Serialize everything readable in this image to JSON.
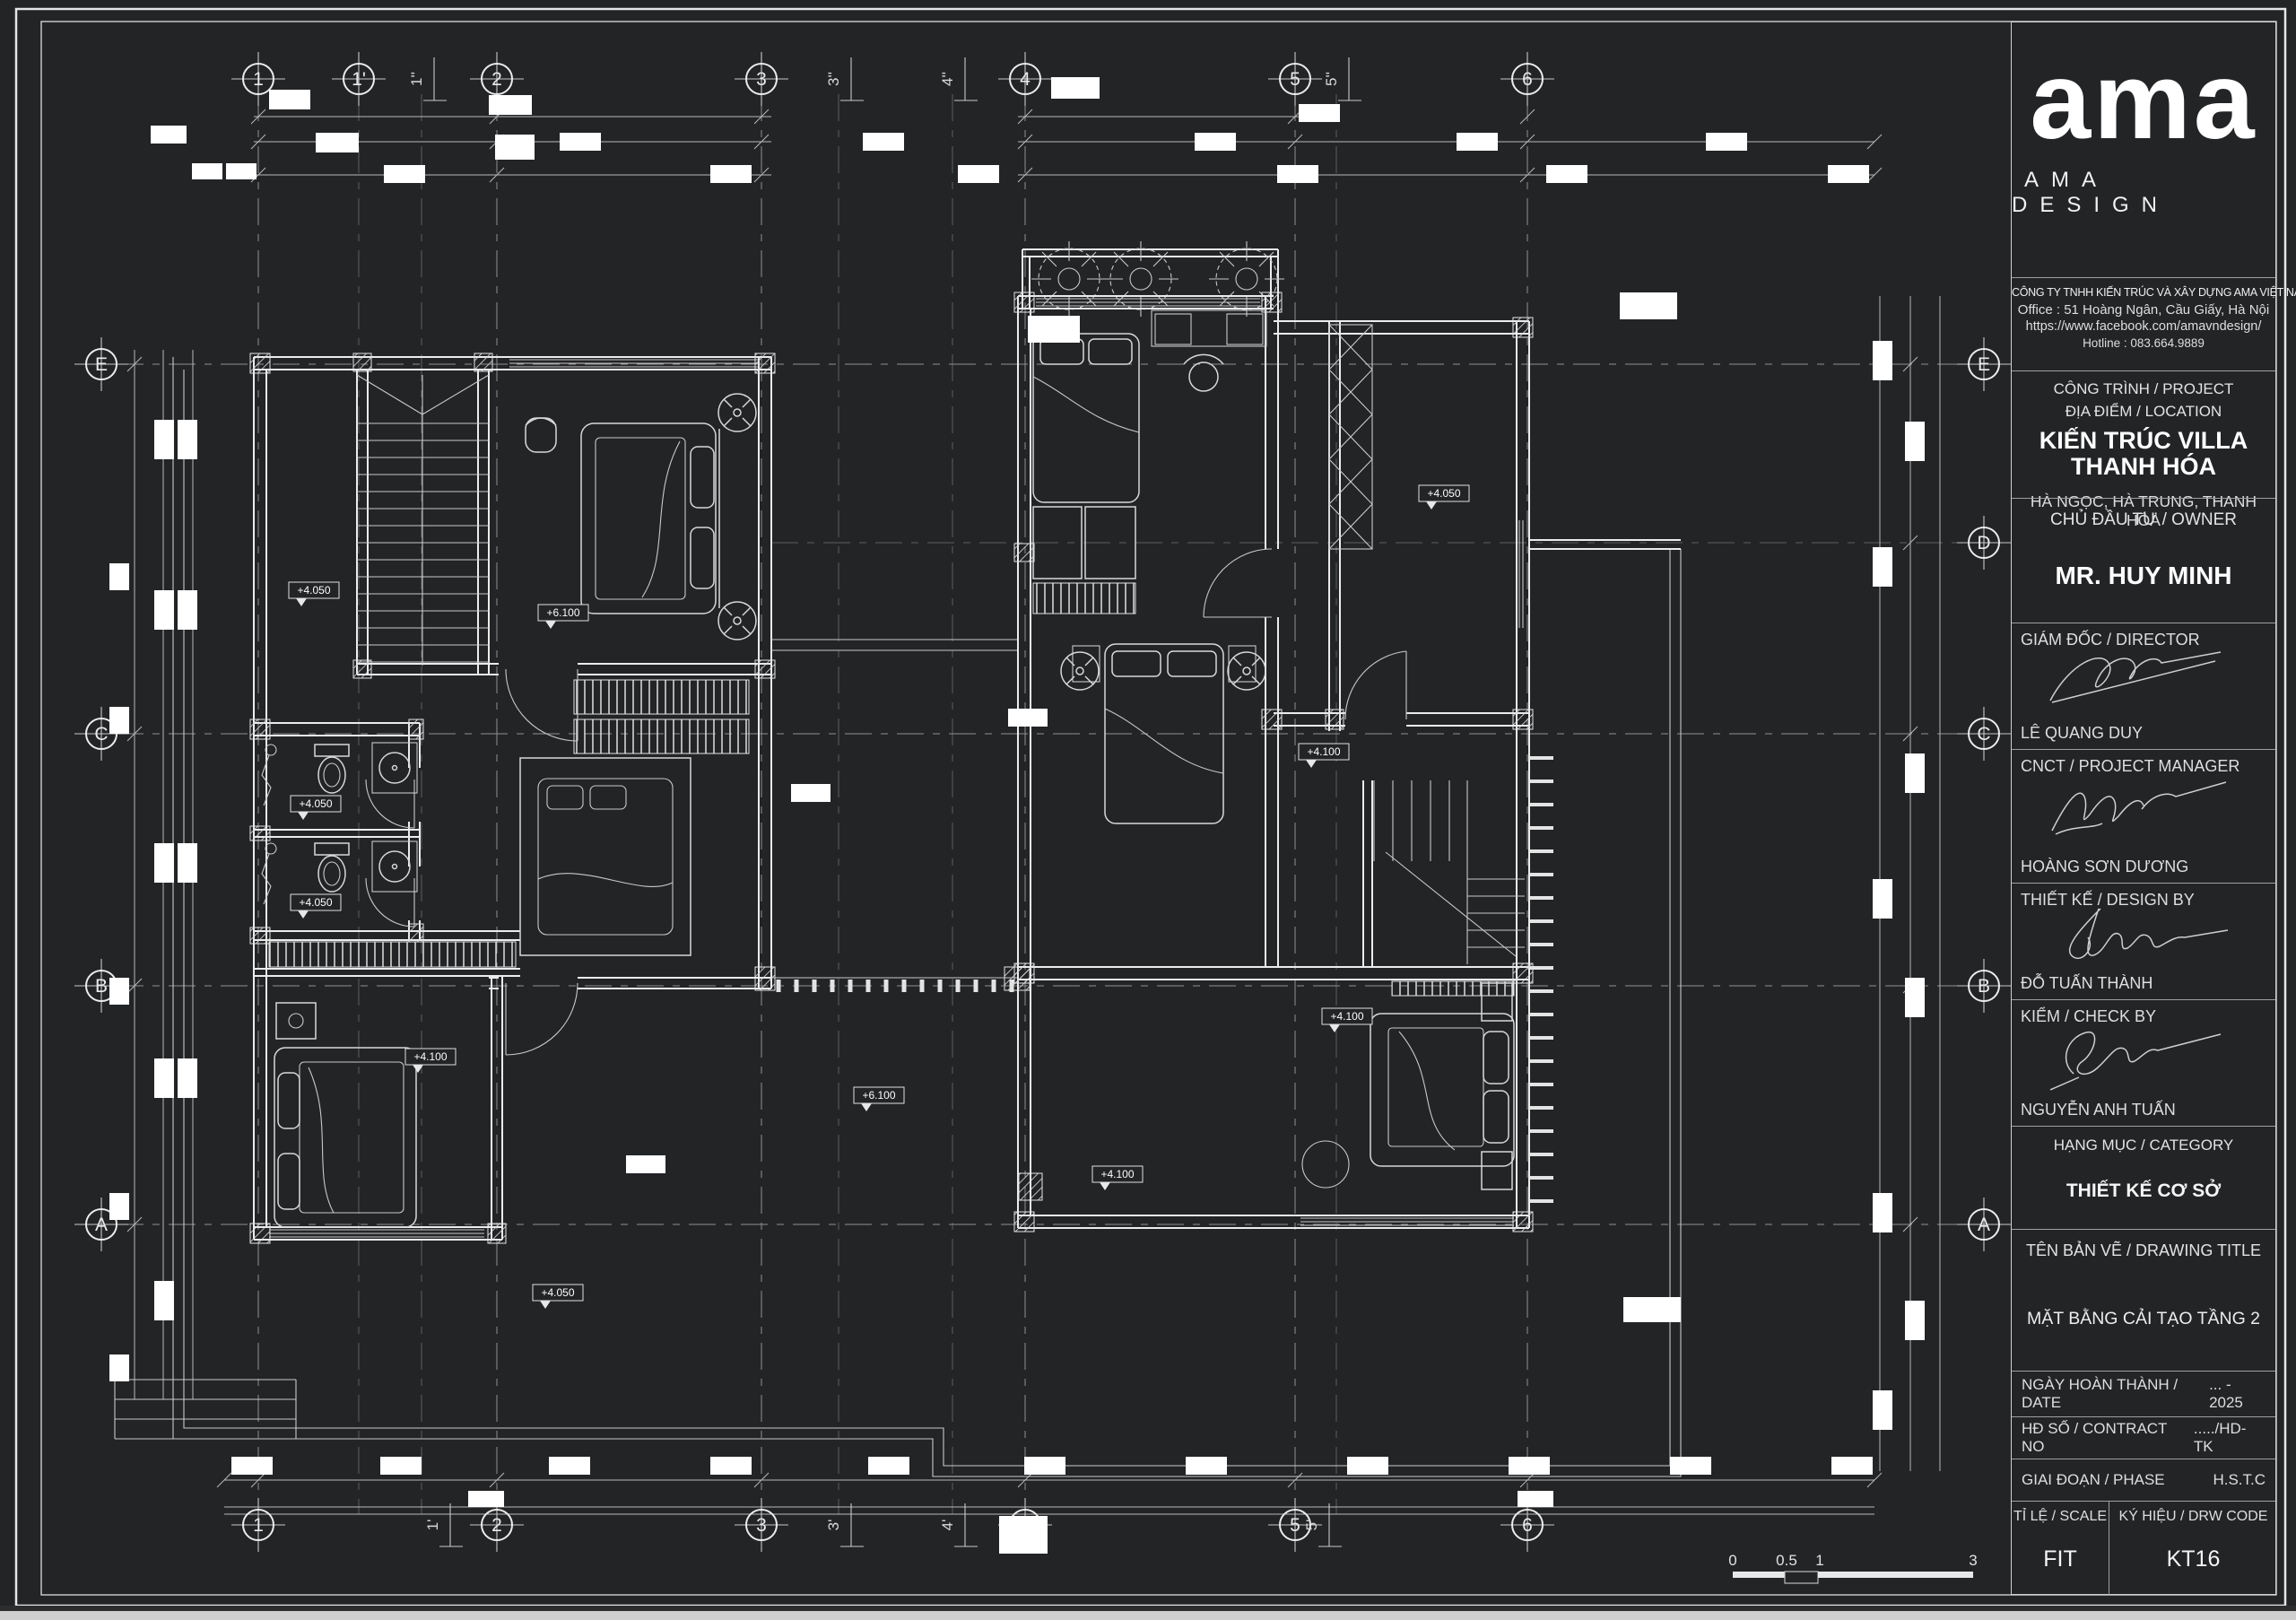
{
  "title_block": {
    "logo_text": "ama",
    "logo_subtext": "AMA DESIGN",
    "company": {
      "name": "CÔNG TY TNHH KIẾN TRÚC VÀ XÂY DỰNG AMA VIỆT NAM",
      "office": "Office : 51 Hoàng Ngân, Cầu Giấy, Hà Nội",
      "facebook": "https://www.facebook.com/amavndesign/",
      "hotline": "Hotline : 083.664.9889"
    },
    "project": {
      "label1": "CÔNG TRÌNH / PROJECT",
      "label2": "ĐỊA ĐIỂM / LOCATION",
      "name_line1": "KIẾN TRÚC VILLA",
      "name_line2": "THANH HÓA",
      "location": "HÀ NGỌC, HÀ TRUNG, THANH HÓA"
    },
    "owner": {
      "label": "CHỦ ĐẦU TƯ / OWNER",
      "name": "MR. HUY MINH"
    },
    "signers": [
      {
        "label": "GIÁM ĐỐC / DIRECTOR",
        "name": "LÊ QUANG DUY"
      },
      {
        "label": "CNCT / PROJECT MANAGER",
        "name": "HOÀNG SƠN DƯƠNG"
      },
      {
        "label": "THIẾT KẾ / DESIGN BY",
        "name": "ĐỖ TUẤN THÀNH"
      },
      {
        "label": "KIỂM / CHECK BY",
        "name": "NGUYỄN ANH TUẤN"
      }
    ],
    "category": {
      "label": "HẠNG MỤC / CATEGORY",
      "value": "THIẾT KẾ CƠ SỞ"
    },
    "drawing": {
      "label": "TÊN BẢN VẼ / DRAWING TITLE",
      "value": "MẶT BẰNG CẢI TẠO TẦNG 2"
    },
    "date": {
      "label": "NGÀY HOÀN THÀNH / DATE",
      "value": "... - 2025"
    },
    "contract": {
      "label": "HĐ SỐ / CONTRACT NO",
      "value": "...../HD-TK"
    },
    "phase": {
      "label": "GIAI ĐOẠN / PHASE",
      "value": "H.S.T.C"
    },
    "scale": {
      "label": "TỈ LỆ / SCALE",
      "value": "FIT"
    },
    "code": {
      "label": "KÝ HIỆU / DRW CODE",
      "value": "KT16"
    }
  },
  "grid": {
    "top": [
      "1",
      "1'",
      "2",
      "3",
      "4",
      "5",
      "6"
    ],
    "top_sub": [
      "1''",
      "3''",
      "4''",
      "5''"
    ],
    "bottom": [
      "1",
      "2",
      "3",
      "4",
      "5",
      "6"
    ],
    "bottom_sub": [
      "1'",
      "3'",
      "4'",
      "5'"
    ],
    "left": [
      "E",
      "C",
      "B",
      "A"
    ],
    "right": [
      "E",
      "D",
      "C",
      "B",
      "A"
    ]
  },
  "levels": [
    "+4.050",
    "+4.050",
    "+4.100",
    "+6.100",
    "+4.100",
    "+4.100",
    "+4.050",
    "+6.100",
    "+4.050",
    "+4.100",
    "+4.050"
  ],
  "scale_bar": {
    "ticks": [
      "0",
      "0.5",
      "1",
      "3"
    ]
  },
  "colors": {
    "paper": "#222426",
    "line": "#ececec",
    "accent": "#ffffff"
  }
}
